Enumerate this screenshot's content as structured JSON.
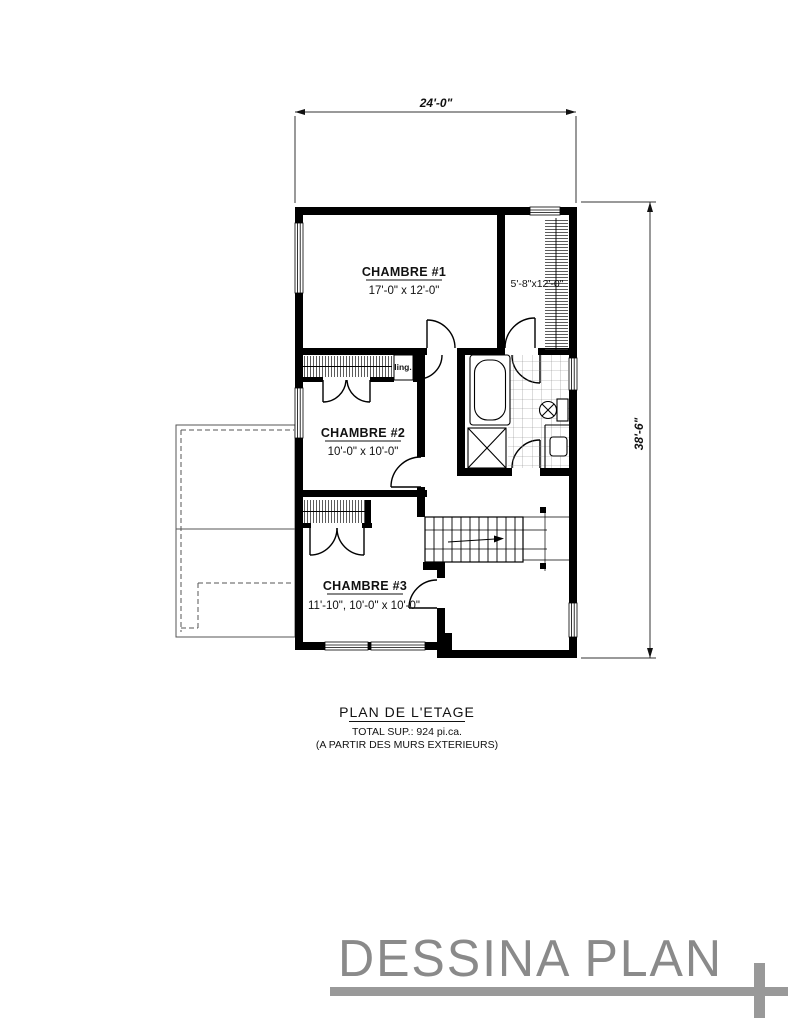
{
  "plan": {
    "dim_top": "24'-0\"",
    "dim_right": "38'-6\"",
    "rooms": [
      {
        "name": "CHAMBRE #1",
        "size": "17'-0\" x 12'-0\""
      },
      {
        "name": "CHAMBRE #2",
        "size": "10'-0\" x 10'-0\""
      },
      {
        "name": "CHAMBRE #3",
        "size": "11'-10\", 10'-0\" x 10'-0\""
      }
    ],
    "closet_label": "5'-8\"x12'-0\"",
    "linen_label": "ling."
  },
  "title_block": {
    "title": "PLAN DE L'ETAGE",
    "subtitle": "TOTAL SUP.: 924 pi.ca.",
    "note": "(A PARTIR DES MURS EXTERIEURS)"
  },
  "logo": {
    "text": "DESSINA PLAN"
  },
  "colors": {
    "wall": "#000000",
    "logo_gray": "#8a8a8a",
    "background": "#ffffff"
  }
}
